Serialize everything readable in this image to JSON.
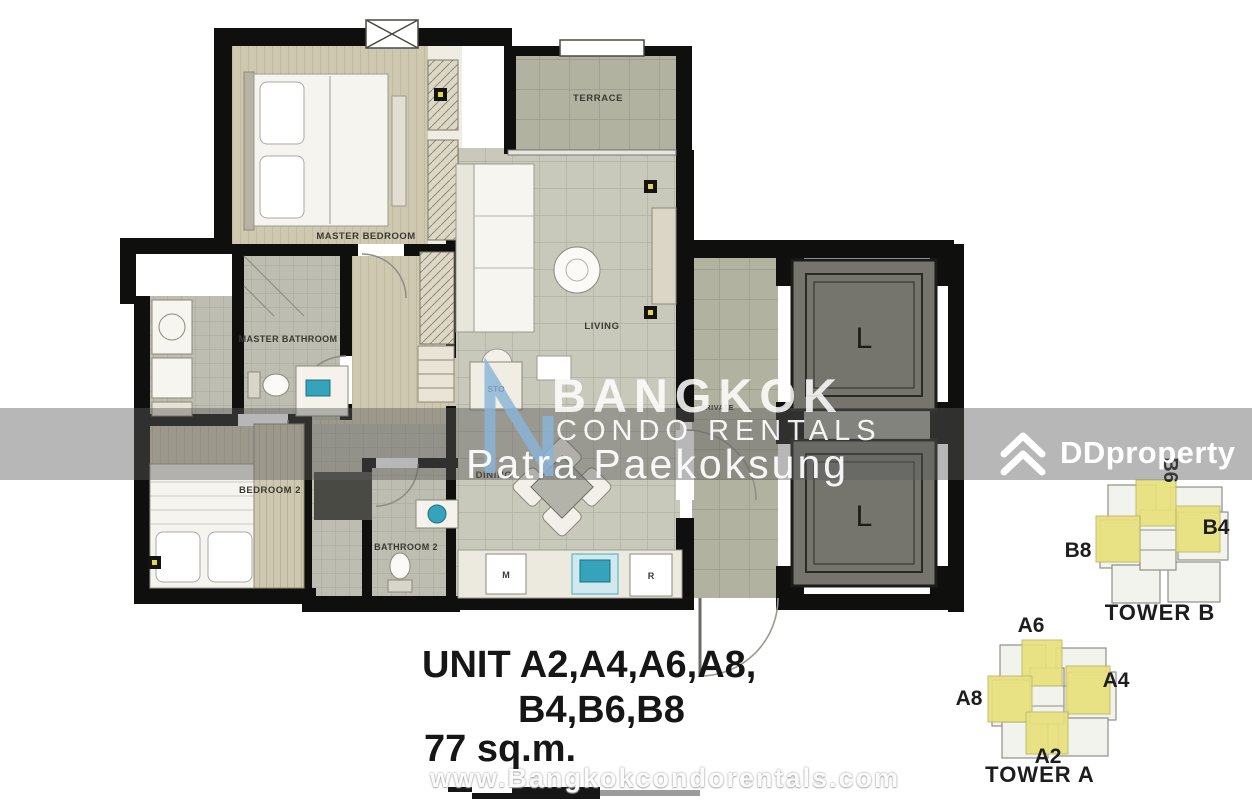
{
  "watermark": {
    "brand_line1": "BANGKOK",
    "brand_line2": "CONDO RENTALS",
    "agent_name": "Patra Paekoksung",
    "url": "www.Bangkokcondorentals.com",
    "logo_blue": "#8ab5d9"
  },
  "ddproperty": {
    "label": "DDproperty",
    "color": "#ffffff"
  },
  "plan": {
    "unit_line1": "UNIT A2,A4,A6,A8,",
    "unit_line2": "B4,B6,B8",
    "area": "77 sq.m.",
    "labels": {
      "master_bedroom": "MASTER BEDROOM",
      "master_bathroom": "MASTER BATHROOM",
      "bedroom_2": "BEDROOM 2",
      "bathroom_2": "BATHROOM 2",
      "terrace": "TERRACE",
      "living": "LIVING",
      "dining": "DINING",
      "storage": "STO",
      "private_hall": "PRIVATE",
      "lift": "L",
      "appliance_m": "M",
      "appliance_r": "R"
    },
    "colors": {
      "wall": "#0f0f0d",
      "wood_floor": "#cfc8b0",
      "tile_floor": "#c9c9bb",
      "terrace_floor": "#b2b2a0",
      "bath_floor": "#bdbdb1",
      "lift_car": "#75756d",
      "accent_teal": "#35a3bb",
      "highlight_yellow": "#e9e17c"
    }
  },
  "towers": {
    "tower_b": {
      "caption": "TOWER B",
      "unit_top": "B6",
      "unit_left": "B8",
      "unit_right": "B4"
    },
    "tower_a": {
      "caption": "TOWER A",
      "unit_top": "A6",
      "unit_left": "A8",
      "unit_right": "A4",
      "unit_bottom": "A2"
    }
  }
}
